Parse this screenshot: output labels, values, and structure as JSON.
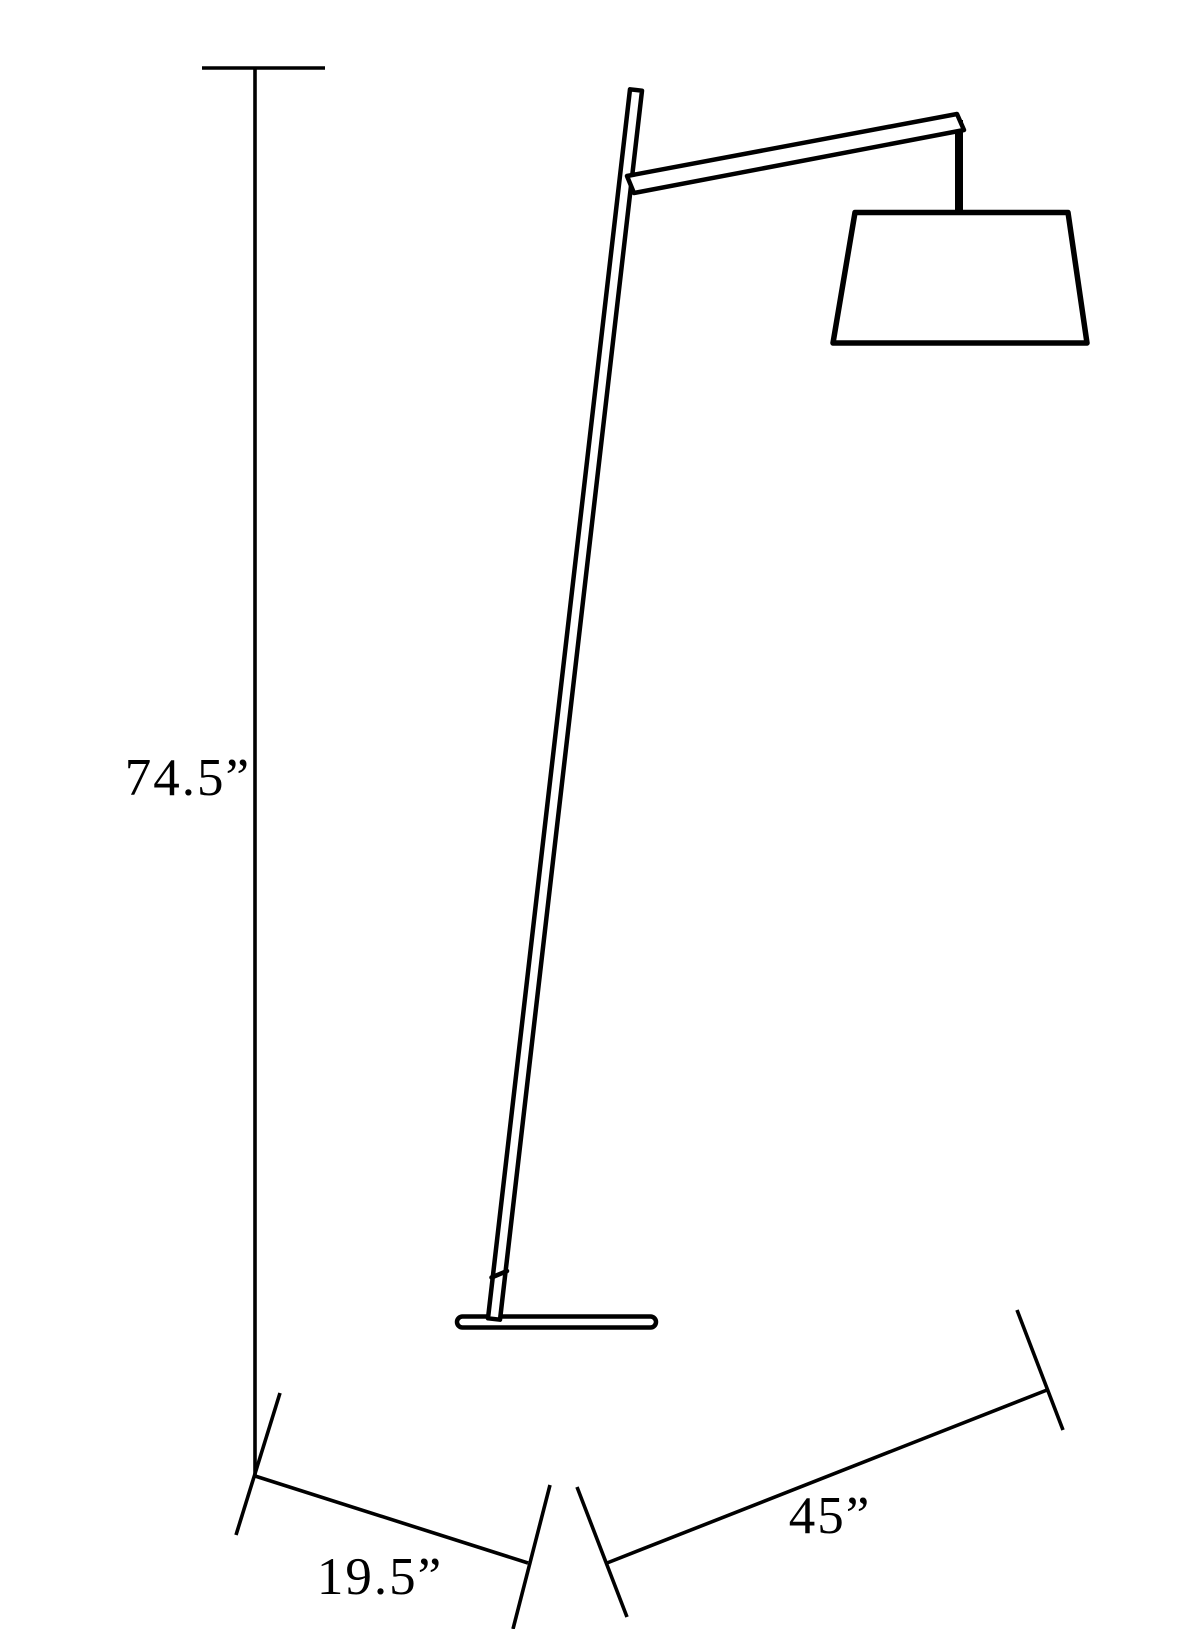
{
  "colors": {
    "line": "#000000",
    "background": "#ffffff"
  },
  "dimensions": {
    "height": {
      "label": "74.5”",
      "value": 74.5,
      "unit_symbol": "”"
    },
    "base_depth": {
      "label": "19.5”",
      "value": 19.5,
      "unit_symbol": "”"
    },
    "arm_reach": {
      "label": "45”",
      "value": 45,
      "unit_symbol": "”"
    }
  }
}
